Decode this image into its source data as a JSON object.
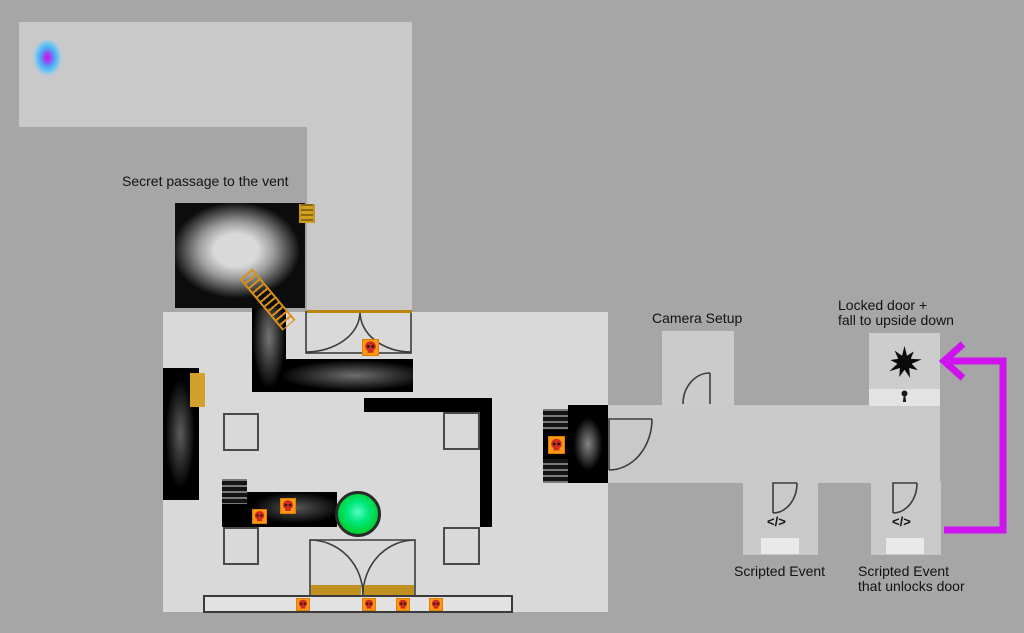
{
  "labels": {
    "secret_passage": "Secret passage to the vent",
    "camera_setup": "Camera Setup",
    "locked_door": [
      "Locked door +",
      "fall to upside down"
    ],
    "scripted_event_1": "Scripted Event",
    "scripted_event_2": [
      "Scripted Event",
      "that unlocks door"
    ],
    "code_symbol_1": "</>",
    "code_symbol_2": "</>"
  },
  "colors": {
    "background": "#a6a6a6",
    "room_light": "#d9d9d9",
    "corridor_light": "#c9c9c9",
    "locked_room": "#cdcdcd",
    "plate_light": "#e3e3e3",
    "walkway_light": "#e2e2e2",
    "wall_black": "#000000",
    "gold": "#c8941e",
    "hazard_orange": "#ff9815",
    "hazard_skull_red": "#cf2b1e",
    "orb_green_center": "#55ffc0",
    "orb_green_edge": "#00c221",
    "portal_core_magenta": "#c913ef",
    "portal_blue": "#52a7f2",
    "arrow_magenta": "#cf13ef"
  },
  "icons": [
    "portal-icon",
    "ladder-icon",
    "vent-hatch-ladder-icon",
    "hazard-skull-icon",
    "door-arc-icon",
    "green-orb-icon",
    "star-burst-icon",
    "keyhole-icon",
    "code-icon",
    "unlock-arrow-icon"
  ]
}
